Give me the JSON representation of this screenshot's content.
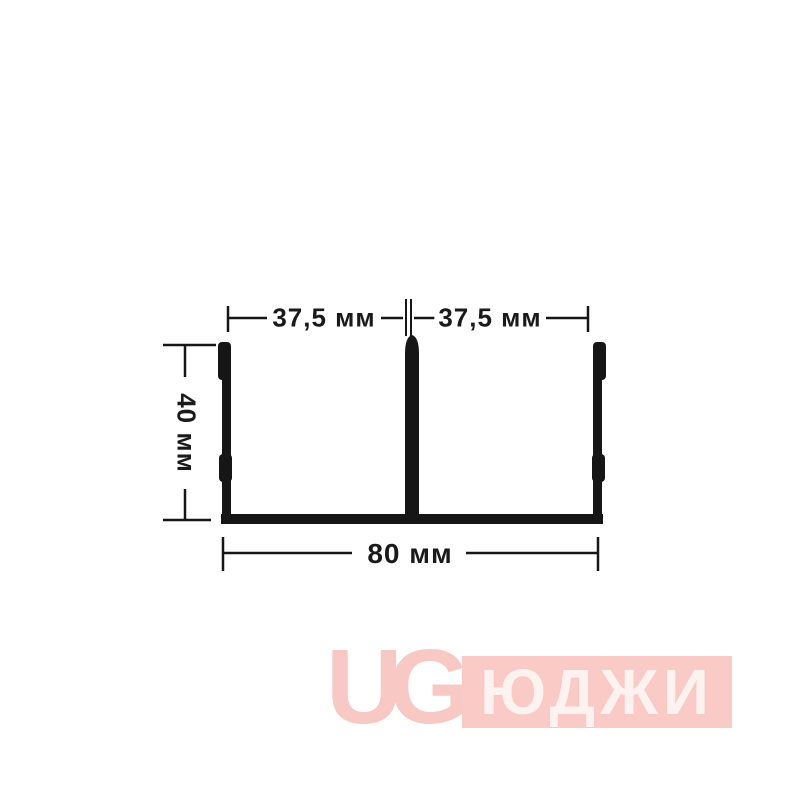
{
  "drawing": {
    "type": "profile-cross-section",
    "dimensions": {
      "top_left": "37,5 мм",
      "top_right": "37,5 мм",
      "left": "40 мм",
      "bottom": "80 мм"
    }
  },
  "watermark": {
    "monogram": "UG",
    "brand": "ЮДЖИ"
  },
  "colors": {
    "ink": "#161616",
    "pink": "#f8c8c4",
    "pink_light": "#fdf2f0",
    "background": "#ffffff"
  }
}
